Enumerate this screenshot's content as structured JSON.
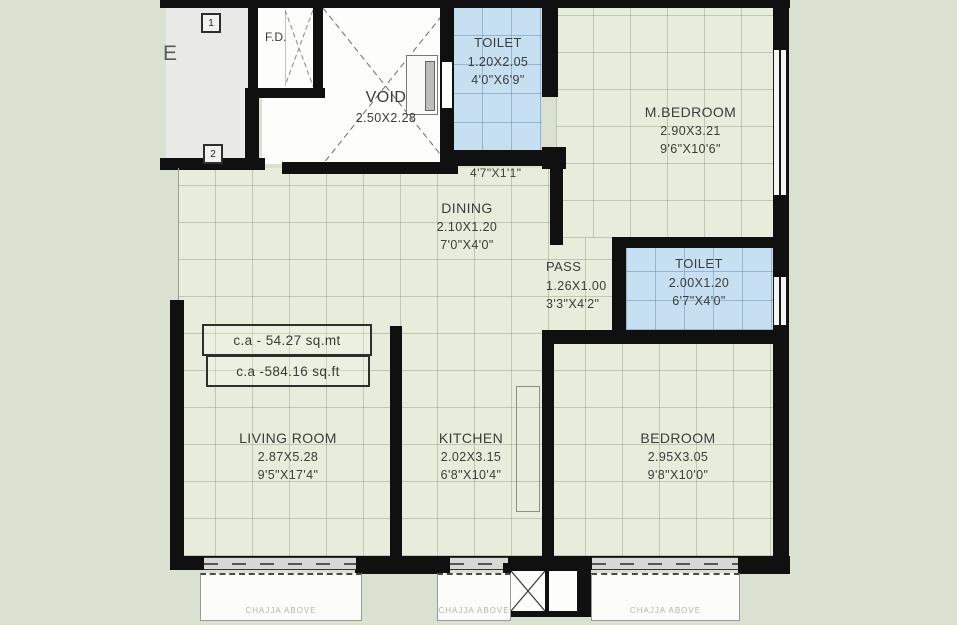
{
  "plan": {
    "title": "apartment-floor-plan",
    "edge_letter": "E",
    "markers": {
      "one": "1",
      "two": "2"
    },
    "fd_label": "F.D.",
    "passage_dim": "4'7\"X1'1\"",
    "area_labels": {
      "sqmt": "c.a - 54.27 sq.mt",
      "sqft": "c.a -584.16 sq.ft"
    },
    "chajja_label": "CHAJJA ABOVE",
    "rooms": {
      "void": {
        "name": "VOID",
        "metric": "2.50X2.28",
        "imperial": ""
      },
      "toilet_top": {
        "name": "TOILET",
        "metric": "1.20X2.05",
        "imperial": "4'0\"X6'9\""
      },
      "m_bedroom": {
        "name": "M.BEDROOM",
        "metric": "2.90X3.21",
        "imperial": "9'6\"X10'6\""
      },
      "dining": {
        "name": "DINING",
        "metric": "2.10X1.20",
        "imperial": "7'0\"X4'0\""
      },
      "pass": {
        "name": "PASS",
        "metric": "1.26X1.00",
        "imperial": "3'3\"X4'2\""
      },
      "toilet_right": {
        "name": "TOILET",
        "metric": "2.00X1.20",
        "imperial": "6'7\"X4'0\""
      },
      "living": {
        "name": "LIVING ROOM",
        "metric": "2.87X5.28",
        "imperial": "9'5\"X17'4\""
      },
      "kitchen": {
        "name": "KITCHEN",
        "metric": "2.02X3.15",
        "imperial": "6'8\"X10'4\""
      },
      "bedroom": {
        "name": "BEDROOM",
        "metric": "2.95X3.05",
        "imperial": "9'8\"X10'0\""
      }
    },
    "colors": {
      "wall": "#101010",
      "floor": "#e7ecdb",
      "toilet": "#c6dff1",
      "corridor": "#e9e9e7",
      "background": "#dae1d1"
    }
  }
}
